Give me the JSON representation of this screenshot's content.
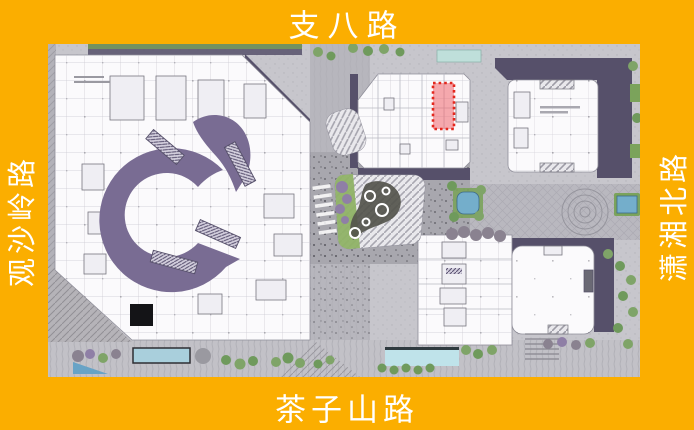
{
  "roads": {
    "top": "支八路",
    "bottom": "茶子山路",
    "left": "观沙岭路",
    "right": "潇湘北路"
  },
  "colors": {
    "frame": "#FBAE00",
    "label_text": "#FFFFFF",
    "pavement": "#C7C6CC",
    "building_white": "#FBFAFC",
    "shadow": "#56506A",
    "atrium_ribbon": "#796C93",
    "highlight_border": "#E3281E",
    "highlight_fill": "rgba(240,100,108,0.55)",
    "tree_green": "#7FA468",
    "planting_green": "#7BA35B",
    "water_blue": "#74AECB",
    "pool_light_blue": "#BFE3EA",
    "pavilion_green_roof": "#8FB266",
    "bush_purple": "#8F7FA6"
  }
}
